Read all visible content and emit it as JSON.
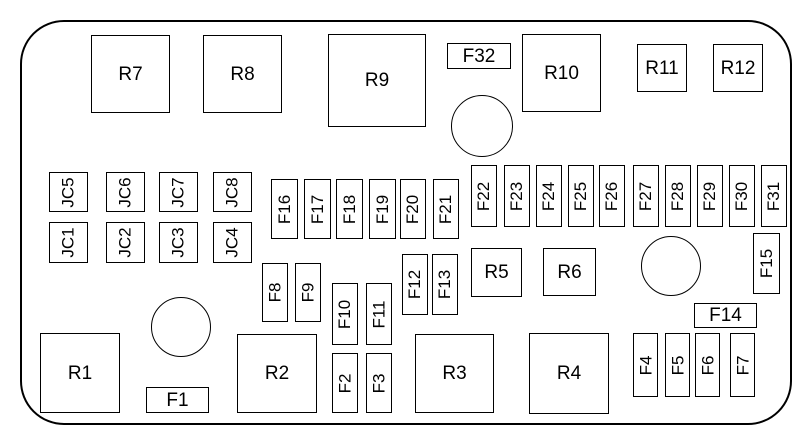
{
  "diagram": {
    "kind": "fuse-box-diagram",
    "background_color": "#ffffff",
    "line_color": "#000000"
  },
  "labels": {
    "R1": "R1",
    "R2": "R2",
    "R3": "R3",
    "R4": "R4",
    "R5": "R5",
    "R6": "R6",
    "R7": "R7",
    "R8": "R8",
    "R9": "R9",
    "R10": "R10",
    "R11": "R11",
    "R12": "R12",
    "F1": "F1",
    "F2": "F2",
    "F3": "F3",
    "F4": "F4",
    "F5": "F5",
    "F6": "F6",
    "F7": "F7",
    "F8": "F8",
    "F9": "F9",
    "F10": "F10",
    "F11": "F11",
    "F12": "F12",
    "F13": "F13",
    "F14": "F14",
    "F15": "F15",
    "F16": "F16",
    "F17": "F17",
    "F18": "F18",
    "F19": "F19",
    "F20": "F20",
    "F21": "F21",
    "F22": "F22",
    "F23": "F23",
    "F24": "F24",
    "F25": "F25",
    "F26": "F26",
    "F27": "F27",
    "F28": "F28",
    "F29": "F29",
    "F30": "F30",
    "F31": "F31",
    "F32": "F32",
    "JC1": "JC1",
    "JC2": "JC2",
    "JC3": "JC3",
    "JC4": "JC4",
    "JC5": "JC5",
    "JC6": "JC6",
    "JC7": "JC7",
    "JC8": "JC8"
  }
}
